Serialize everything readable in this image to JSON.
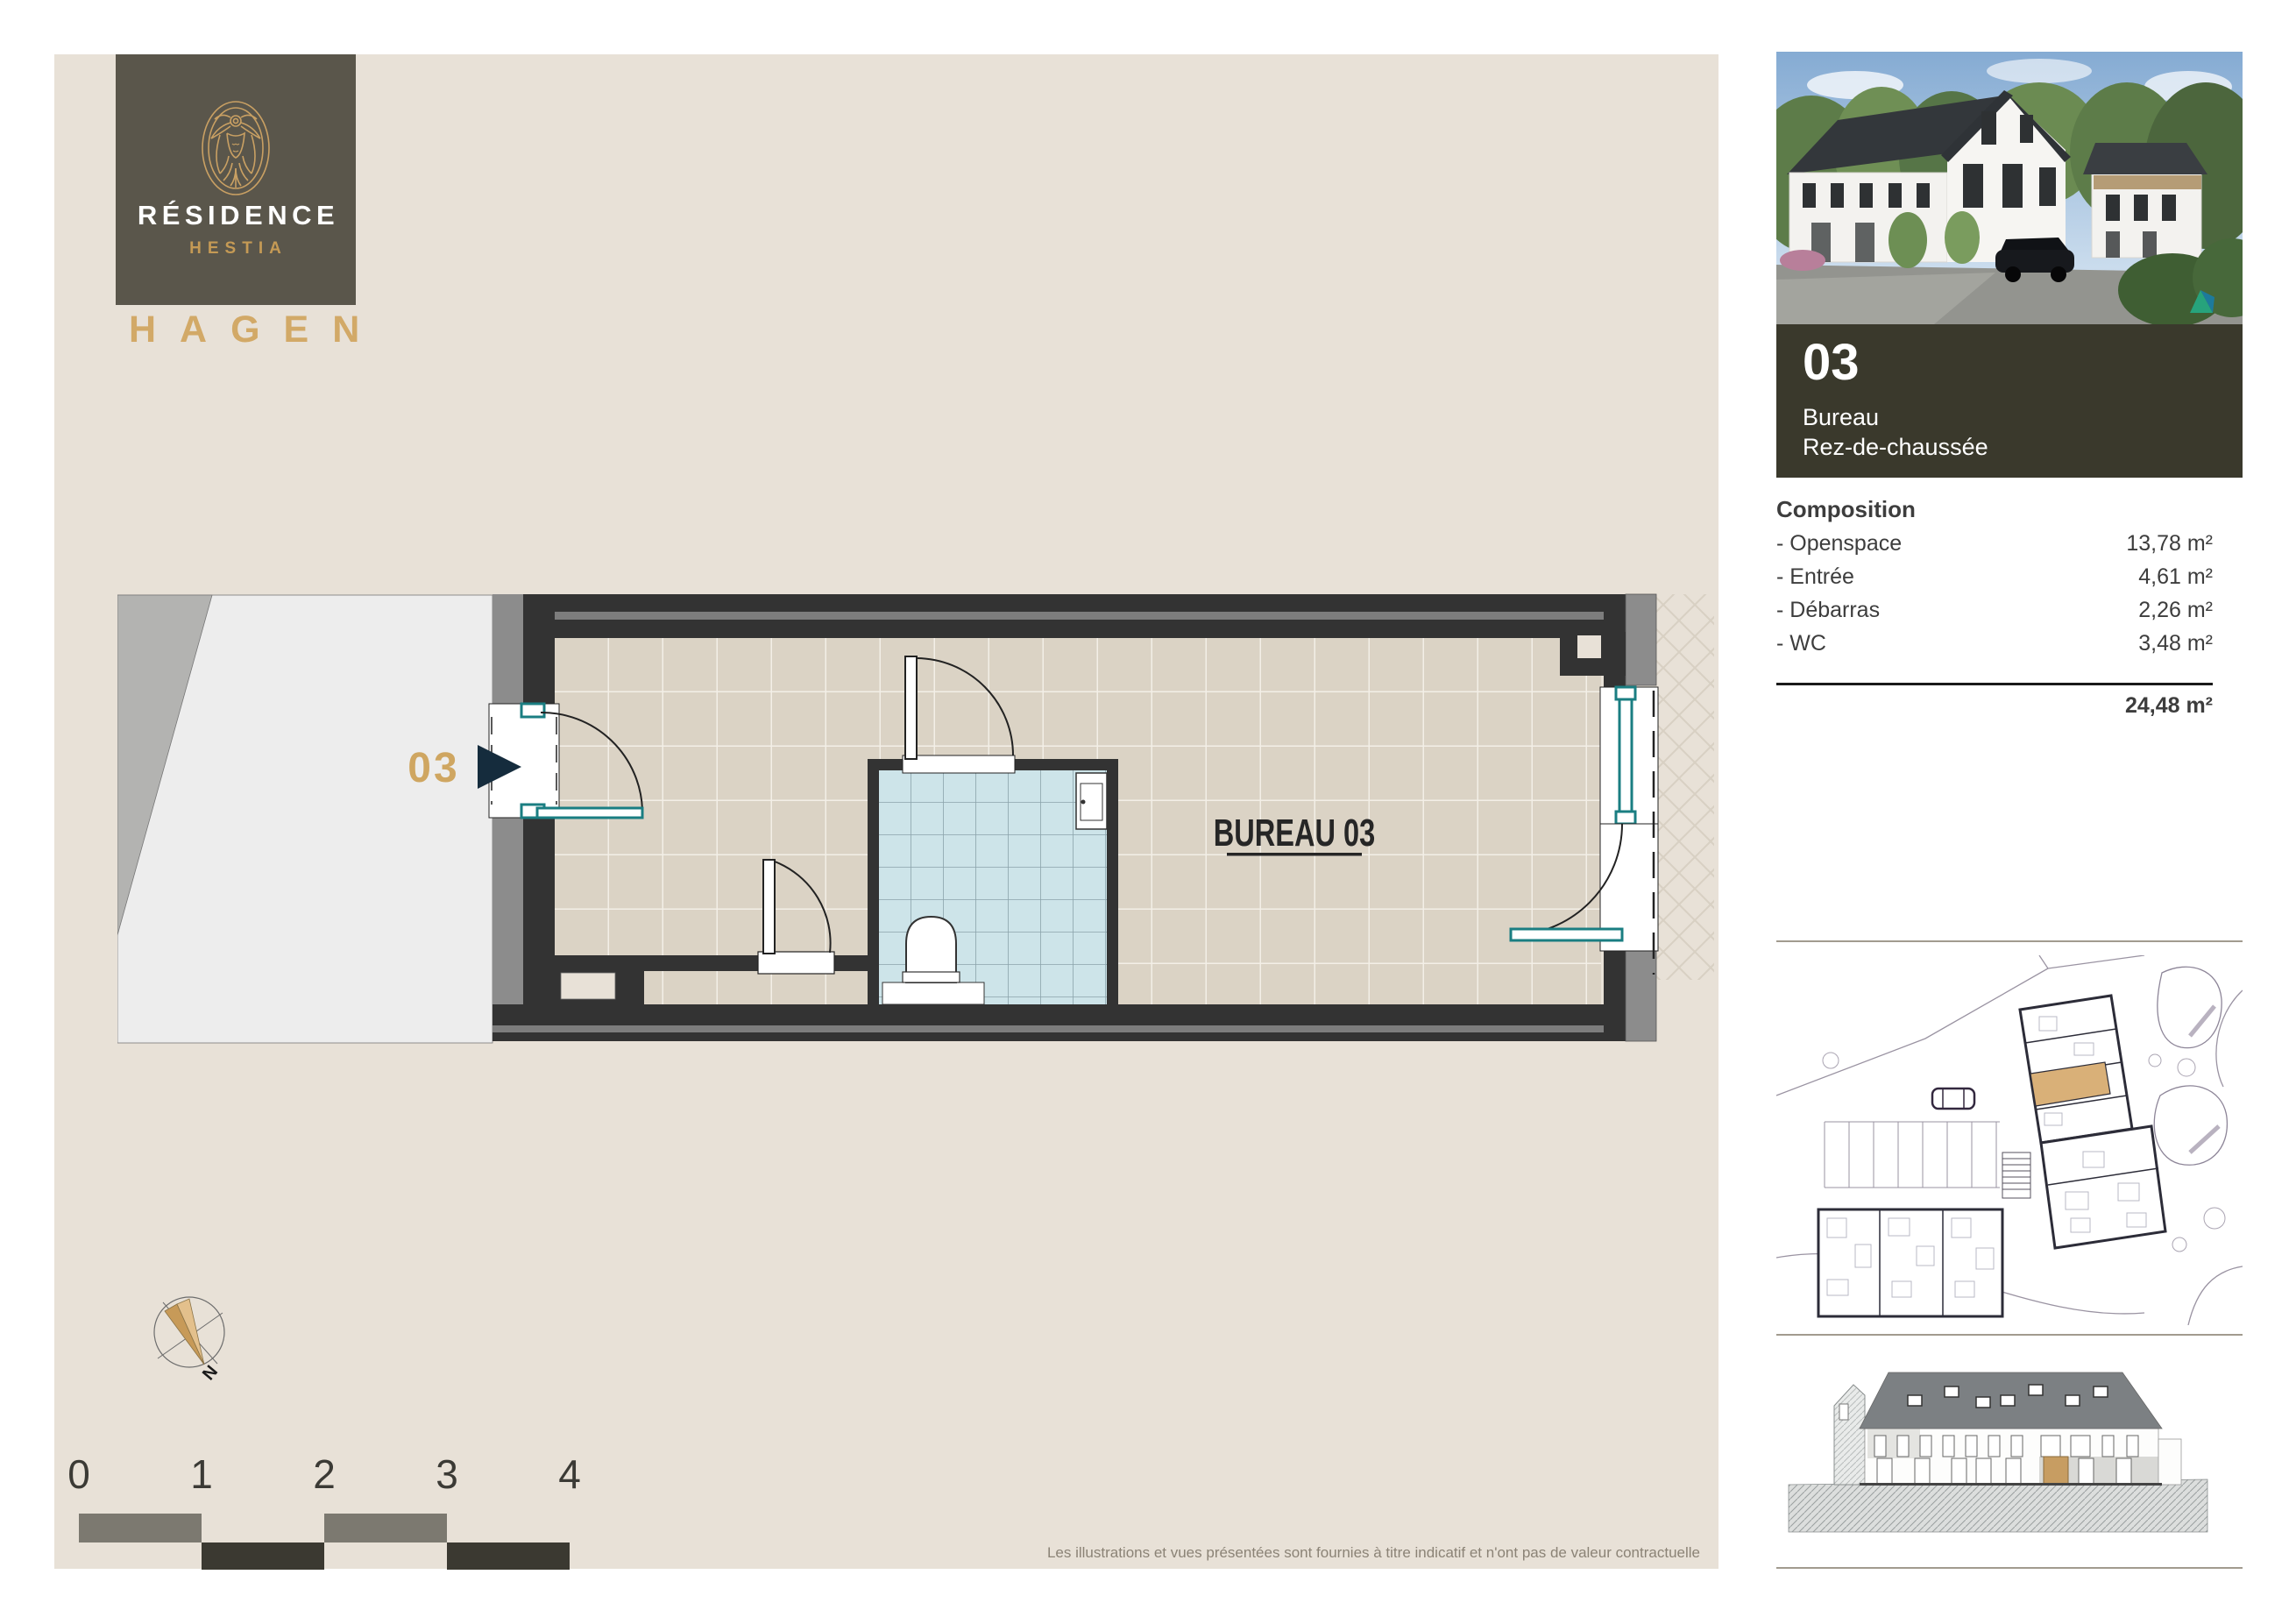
{
  "brand": {
    "name_line1": "RÉSIDENCE",
    "name_line2": "HESTIA",
    "location": "HAGEN"
  },
  "plan": {
    "unit_marker": "03",
    "room_label": "BUREAU 03"
  },
  "sidebar": {
    "unit": {
      "number": "03",
      "type": "Bureau",
      "floor": "Rez-de-chaussée"
    },
    "composition": {
      "title": "Composition",
      "items": [
        {
          "label": "- Openspace",
          "value": "13,78 m²"
        },
        {
          "label": "- Entrée",
          "value": "4,61 m²"
        },
        {
          "label": "- Débarras",
          "value": "2,26 m²"
        },
        {
          "label": "- WC",
          "value": "3,48 m²"
        }
      ],
      "total": "24,48 m²"
    }
  },
  "scale_bar": {
    "labels": [
      "0",
      "1",
      "2",
      "3",
      "4"
    ]
  },
  "compass": {
    "north_label": "N"
  },
  "footer": {
    "disclaimer": "Les illustrations et vues présentées sont fournies à titre indicatif et n'ont pas de valeur contractuelle"
  },
  "colors": {
    "accent_gold": "#c9a265",
    "navy_arrow": "#152c3d",
    "teal_joinery": "#1a7e82",
    "panel_beige": "#e8e1d7",
    "logo_box": "#5a564b",
    "info_box": "#3a392c",
    "highlight_unit": "#d9b078"
  }
}
